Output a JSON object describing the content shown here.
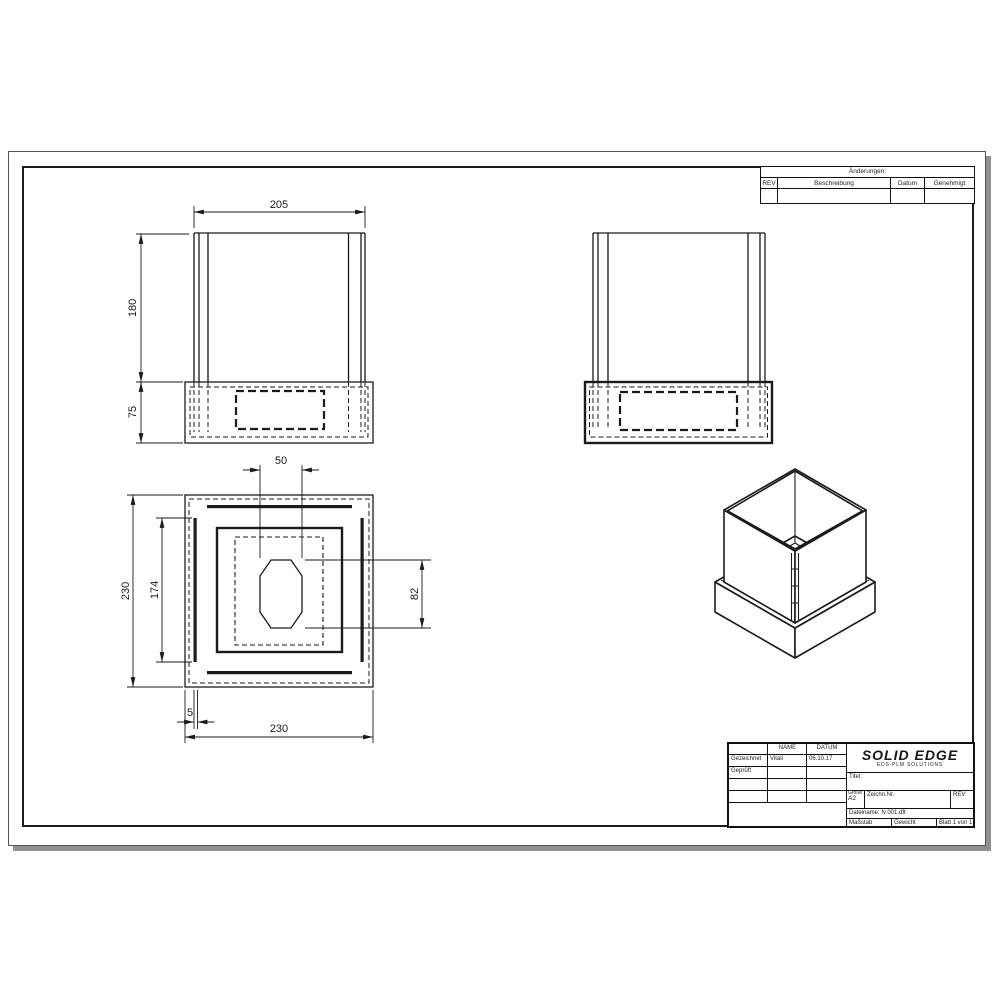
{
  "sheet": {
    "background": "#ffffff",
    "line_color": "#1b1b1b"
  },
  "revision_table": {
    "title": "Änderungen:",
    "columns": [
      "REV",
      "Beschreibung",
      "Datum",
      "Genehmigt"
    ]
  },
  "title_block": {
    "name_header": "NAME",
    "date_header": "DATUM",
    "rows": [
      {
        "label": "Gezeichnet",
        "name": "Vitali",
        "date": "06.10.17"
      },
      {
        "label": "Geprüft",
        "name": "",
        "date": ""
      }
    ],
    "logo_text": "SOLID EDGE",
    "logo_subtext": "EDS-PLM SOLUTIONS",
    "title_label": "Titel:",
    "size_label": "Größe",
    "size_value": "A2",
    "drawing_number_label": "Zeichn.Nr.",
    "rev_label": "REV",
    "filename_label": "Dateiname: N 001.dft",
    "scale_label": "Maßstab",
    "weight_label": "Gewicht",
    "sheet_number_label": "Blatt 1 von 1"
  },
  "dimensions": {
    "front_width": "205",
    "front_wall_height": "180",
    "front_base_height": "75",
    "top_hole_width": "50",
    "top_overall_height": "230",
    "top_slot_length": "174",
    "top_hole_height": "82",
    "top_slot_width": "5",
    "top_overall_width": "230"
  }
}
